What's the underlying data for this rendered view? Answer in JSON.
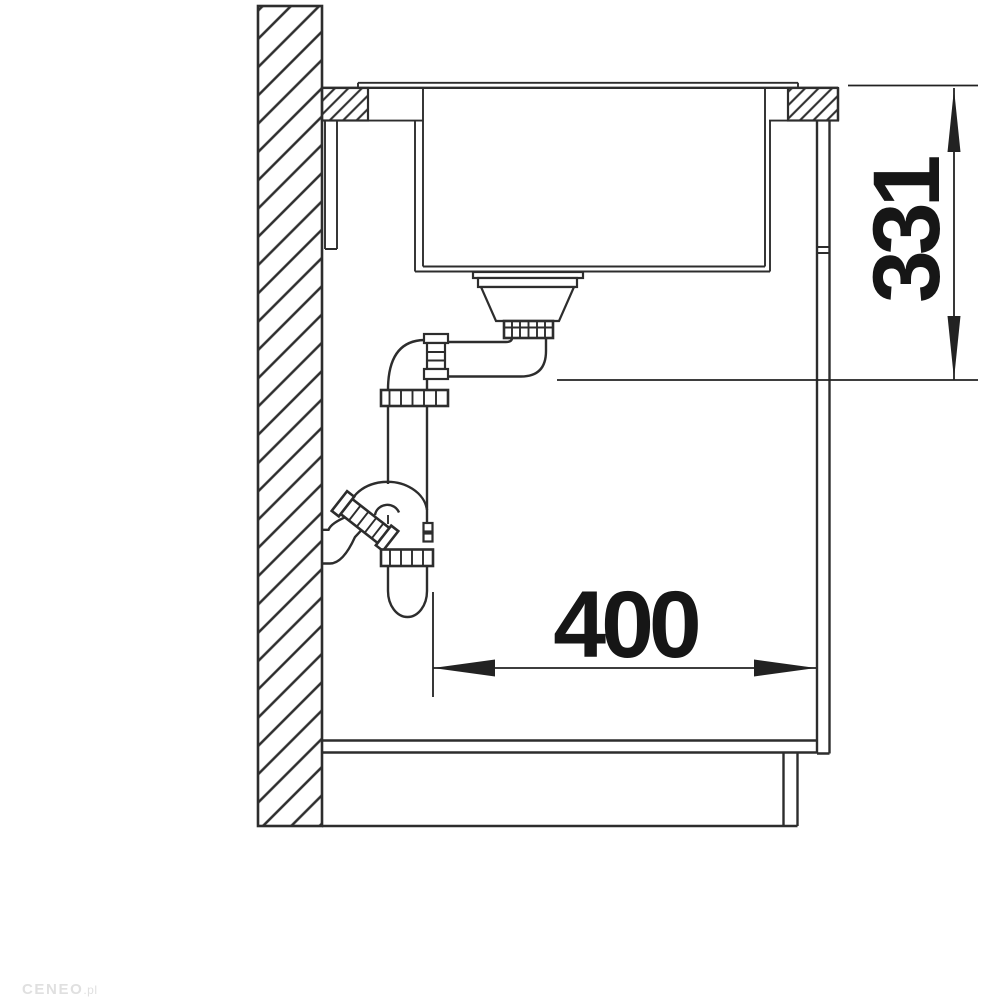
{
  "diagram": {
    "kind": "sink-installation-side-section",
    "dimensions": {
      "height": "331",
      "depth": "400"
    },
    "watermark": {
      "brand": "CENEO",
      "suffix": ".pl"
    },
    "colors": {
      "line": "#2d2d2d",
      "dimension_text": "#161616",
      "background": "#ffffff",
      "watermark": "#e0e0e0"
    }
  }
}
